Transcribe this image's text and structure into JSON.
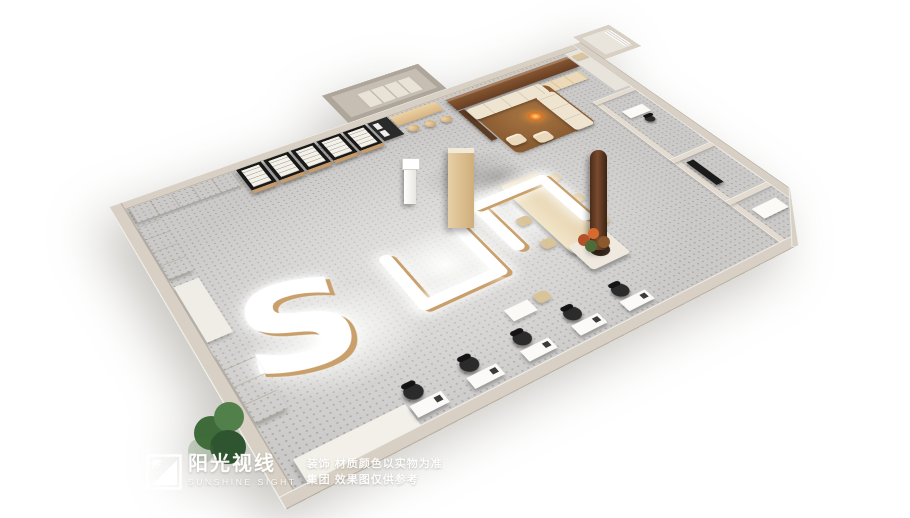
{
  "image": {
    "kind": "3d-interior-rendering",
    "subject": "optical / retail store floor-plan perspective render"
  },
  "watermark": {
    "logo_icon": "sunburst-square-logo-icon",
    "brand_cn": "阳光视线",
    "brand_en": "SUNSHINE SIGHT",
    "disclaimer_line1": "装饰 材质颜色以实物为准",
    "disclaimer_line2": "集团 效果图仅供参考"
  },
  "palette": {
    "background": "#ffffff",
    "wall": "#d8d0c4",
    "floor": "#cbcac8",
    "wood_light": "#d9b98c",
    "wood_dark": "#6f4426",
    "counter_glow": "#ffffff",
    "counter_base": "#c9a06b",
    "display_case_black": "#181818",
    "sofa_beige": "#efe4d0",
    "rug_brown": "#8a5c32",
    "fire_orange": "#e67722",
    "plant_green": "#3f6b3a"
  }
}
